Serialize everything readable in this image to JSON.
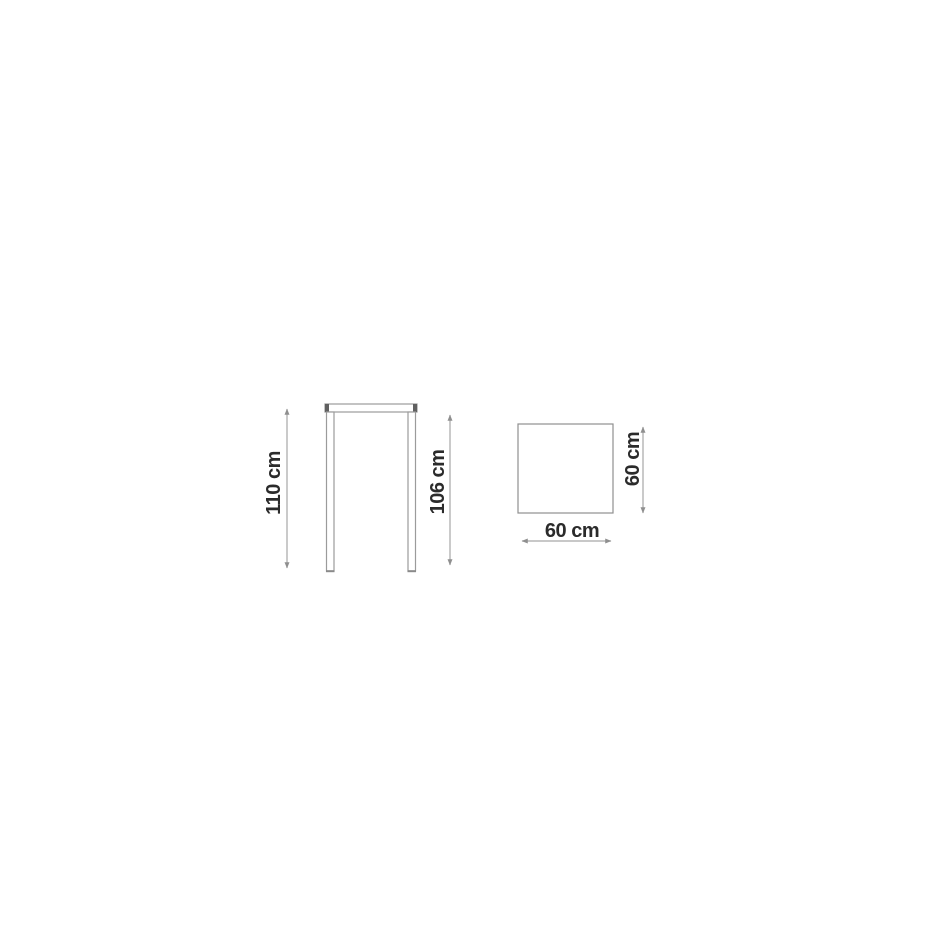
{
  "drawing": {
    "subject": "bar-table-dimension-drawing",
    "front_view": {
      "total_height_label": "110 cm",
      "under_top_height_label": "106 cm"
    },
    "top_view": {
      "width_label": "60 cm",
      "depth_label": "60 cm"
    },
    "colors": {
      "background": "#ffffff",
      "outline": "#9b9b9b",
      "square_outline": "#8f8f8f",
      "end_cap": "#606060",
      "foot_cap": "#8a8a8a",
      "dimension_line": "#a6a6a6",
      "arrow": "#8f8f8f",
      "label_text": "#2b2b2b"
    }
  }
}
